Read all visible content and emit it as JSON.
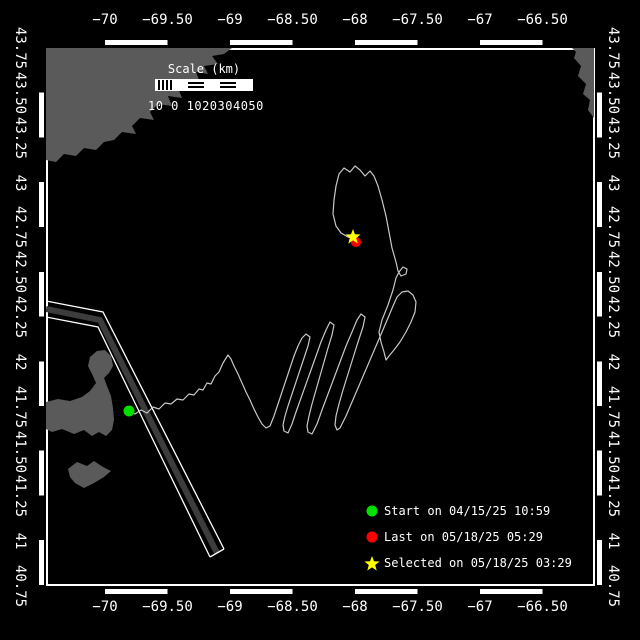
{
  "window": {
    "background": "#000000",
    "foreground": "#ffffff"
  },
  "axes": {
    "lon_ticks": [
      {
        "label": "−70",
        "x": 105
      },
      {
        "label": "−69.50",
        "x": 167.5
      },
      {
        "label": "−69",
        "x": 230
      },
      {
        "label": "−68.50",
        "x": 292.5
      },
      {
        "label": "−68",
        "x": 355
      },
      {
        "label": "−67.50",
        "x": 417.5
      },
      {
        "label": "−67",
        "x": 480
      },
      {
        "label": "−66.50",
        "x": 542.5
      }
    ],
    "lat_ticks": [
      {
        "label": "43.75",
        "y": 48
      },
      {
        "label": "43.50",
        "y": 92.8
      },
      {
        "label": "43.25",
        "y": 137.7
      },
      {
        "label": "43",
        "y": 182.5
      },
      {
        "label": "42.75",
        "y": 227.3
      },
      {
        "label": "42.50",
        "y": 272.2
      },
      {
        "label": "42.25",
        "y": 317
      },
      {
        "label": "42",
        "y": 361.8
      },
      {
        "label": "41.75",
        "y": 406.7
      },
      {
        "label": "41.50",
        "y": 451.5
      },
      {
        "label": "41.25",
        "y": 496.3
      },
      {
        "label": "41",
        "y": 541.2
      },
      {
        "label": "40.75",
        "y": 586
      }
    ]
  },
  "scalebar": {
    "title": "Scale (km)",
    "labels": "10 0 1020304050",
    "segments": [
      "hatch",
      "solid",
      "striped",
      "solid",
      "striped",
      "solid"
    ]
  },
  "legend": {
    "items": [
      {
        "marker": "circle",
        "color": "#00e000",
        "text": "Start on 04/15/25 10:59"
      },
      {
        "marker": "circle",
        "color": "#ff0000",
        "text": "Last on 05/18/25 05:29"
      },
      {
        "marker": "star",
        "color": "#ffff00",
        "text": "Selected on 05/18/25 03:29"
      }
    ]
  },
  "chart_data": {
    "type": "scatter",
    "title": "Glider track map",
    "xlabel": "Longitude (deg)",
    "ylabel": "Latitude (deg)",
    "xlim": [
      -70.48,
      -66.08
    ],
    "ylim": [
      40.75,
      43.75
    ],
    "legend_position": "bottom-right",
    "grid": false,
    "markers": {
      "start": {
        "lon": -69.81,
        "lat": 41.72,
        "label": "Start on 04/15/25 10:59"
      },
      "last": {
        "lon": -67.99,
        "lat": 42.67,
        "label": "Last on 05/18/25 05:29"
      },
      "selected": {
        "lon": -68.02,
        "lat": 42.7,
        "label": "Selected on 05/18/25 03:29"
      }
    }
  },
  "map": {
    "colors": {
      "land": "#5a5a5a",
      "track": "#c8c8c8",
      "lane_band": "#3c3c3c",
      "line": "#ffffff"
    },
    "land": [
      {
        "name": "maine-coast",
        "points": [
          [
            46,
            48
          ],
          [
            232,
            48
          ],
          [
            224,
            54
          ],
          [
            212,
            56
          ],
          [
            218,
            64
          ],
          [
            204,
            66
          ],
          [
            208,
            74
          ],
          [
            196,
            72
          ],
          [
            200,
            82
          ],
          [
            186,
            80
          ],
          [
            190,
            90
          ],
          [
            178,
            88
          ],
          [
            182,
            98
          ],
          [
            168,
            96
          ],
          [
            172,
            106
          ],
          [
            158,
            104
          ],
          [
            150,
            112
          ],
          [
            154,
            120
          ],
          [
            140,
            118
          ],
          [
            132,
            126
          ],
          [
            136,
            134
          ],
          [
            122,
            132
          ],
          [
            114,
            140
          ],
          [
            104,
            142
          ],
          [
            96,
            150
          ],
          [
            84,
            148
          ],
          [
            76,
            156
          ],
          [
            64,
            154
          ],
          [
            56,
            162
          ],
          [
            46,
            160
          ]
        ]
      },
      {
        "name": "nova-scotia",
        "points": [
          [
            572,
            48
          ],
          [
            594,
            48
          ],
          [
            594,
            118
          ],
          [
            588,
            110
          ],
          [
            590,
            100
          ],
          [
            583,
            94
          ],
          [
            586,
            84
          ],
          [
            578,
            76
          ],
          [
            581,
            66
          ],
          [
            574,
            58
          ],
          [
            576,
            52
          ]
        ]
      },
      {
        "name": "cape-cod",
        "points": [
          [
            46,
            402
          ],
          [
            58,
            399
          ],
          [
            70,
            401
          ],
          [
            82,
            397
          ],
          [
            90,
            391
          ],
          [
            96,
            383
          ],
          [
            92,
            374
          ],
          [
            88,
            366
          ],
          [
            90,
            357
          ],
          [
            97,
            351
          ],
          [
            105,
            350
          ],
          [
            111,
            356
          ],
          [
            113,
            366
          ],
          [
            109,
            373
          ],
          [
            104,
            378
          ],
          [
            107,
            386
          ],
          [
            111,
            396
          ],
          [
            113,
            408
          ],
          [
            114,
            420
          ],
          [
            112,
            430
          ],
          [
            106,
            436
          ],
          [
            99,
            432
          ],
          [
            92,
            436
          ],
          [
            84,
            430
          ],
          [
            74,
            434
          ],
          [
            62,
            429
          ],
          [
            52,
            432
          ],
          [
            46,
            429
          ]
        ]
      },
      {
        "name": "islands",
        "points": [
          [
            68,
            469
          ],
          [
            77,
            462
          ],
          [
            87,
            466
          ],
          [
            94,
            461
          ],
          [
            103,
            467
          ],
          [
            111,
            471
          ],
          [
            104,
            477
          ],
          [
            94,
            483
          ],
          [
            84,
            488
          ],
          [
            75,
            483
          ],
          [
            70,
            477
          ]
        ]
      }
    ],
    "lane": {
      "outer": [
        [
          46,
          301
        ],
        [
          103,
          312
        ],
        [
          224,
          549
        ]
      ],
      "inner": [
        [
          46,
          317
        ],
        [
          98,
          327
        ],
        [
          210,
          557
        ]
      ],
      "band": [
        [
          46,
          309
        ],
        [
          100,
          320
        ],
        [
          217,
          553
        ]
      ],
      "cap": [
        [
          210,
          557
        ],
        [
          224,
          549
        ]
      ]
    },
    "track": [
      [
        129,
        411
      ],
      [
        135,
        414
      ],
      [
        141,
        410
      ],
      [
        147,
        413
      ],
      [
        153,
        407
      ],
      [
        159,
        409
      ],
      [
        165,
        403
      ],
      [
        171,
        404
      ],
      [
        177,
        399
      ],
      [
        183,
        400
      ],
      [
        189,
        394
      ],
      [
        194,
        395
      ],
      [
        199,
        389
      ],
      [
        203,
        390
      ],
      [
        207,
        383
      ],
      [
        211,
        384
      ],
      [
        215,
        376
      ],
      [
        219,
        372
      ],
      [
        223,
        363
      ],
      [
        228,
        355
      ],
      [
        231,
        359
      ],
      [
        234,
        366
      ],
      [
        238,
        374
      ],
      [
        242,
        383
      ],
      [
        246,
        392
      ],
      [
        250,
        400
      ],
      [
        254,
        409
      ],
      [
        258,
        417
      ],
      [
        262,
        424
      ],
      [
        266,
        428
      ],
      [
        270,
        426
      ],
      [
        274,
        416
      ],
      [
        278,
        404
      ],
      [
        282,
        392
      ],
      [
        286,
        380
      ],
      [
        290,
        368
      ],
      [
        294,
        356
      ],
      [
        298,
        346
      ],
      [
        302,
        338
      ],
      [
        306,
        334
      ],
      [
        310,
        337
      ],
      [
        308,
        346
      ],
      [
        304,
        358
      ],
      [
        300,
        370
      ],
      [
        296,
        382
      ],
      [
        292,
        394
      ],
      [
        288,
        406
      ],
      [
        285,
        416
      ],
      [
        283,
        425
      ],
      [
        284,
        431
      ],
      [
        288,
        433
      ],
      [
        292,
        424
      ],
      [
        296,
        412
      ],
      [
        301,
        398
      ],
      [
        306,
        384
      ],
      [
        311,
        370
      ],
      [
        316,
        356
      ],
      [
        321,
        342
      ],
      [
        326,
        330
      ],
      [
        330,
        322
      ],
      [
        334,
        325
      ],
      [
        332,
        335
      ],
      [
        328,
        348
      ],
      [
        324,
        362
      ],
      [
        320,
        376
      ],
      [
        316,
        390
      ],
      [
        312,
        404
      ],
      [
        309,
        416
      ],
      [
        307,
        426
      ],
      [
        308,
        432
      ],
      [
        312,
        434
      ],
      [
        317,
        424
      ],
      [
        322,
        410
      ],
      [
        328,
        394
      ],
      [
        334,
        378
      ],
      [
        340,
        362
      ],
      [
        346,
        346
      ],
      [
        352,
        332
      ],
      [
        357,
        320
      ],
      [
        361,
        314
      ],
      [
        365,
        317
      ],
      [
        363,
        327
      ],
      [
        358,
        342
      ],
      [
        353,
        358
      ],
      [
        348,
        374
      ],
      [
        343,
        390
      ],
      [
        339,
        404
      ],
      [
        336,
        416
      ],
      [
        335,
        425
      ],
      [
        337,
        430
      ],
      [
        340,
        428
      ],
      [
        346,
        416
      ],
      [
        352,
        402
      ],
      [
        358,
        388
      ],
      [
        364,
        374
      ],
      [
        370,
        360
      ],
      [
        376,
        346
      ],
      [
        382,
        332
      ],
      [
        388,
        318
      ],
      [
        393,
        306
      ],
      [
        397,
        297
      ],
      [
        402,
        292
      ],
      [
        408,
        291
      ],
      [
        413,
        295
      ],
      [
        416,
        302
      ],
      [
        415,
        312
      ],
      [
        411,
        322
      ],
      [
        406,
        332
      ],
      [
        400,
        342
      ],
      [
        394,
        350
      ],
      [
        389,
        356
      ],
      [
        386,
        360
      ],
      [
        384,
        352
      ],
      [
        381,
        342
      ],
      [
        379,
        332
      ],
      [
        382,
        320
      ],
      [
        388,
        305
      ],
      [
        393,
        290
      ],
      [
        396,
        278
      ],
      [
        399,
        272
      ],
      [
        403,
        267
      ],
      [
        407,
        269
      ],
      [
        406,
        274
      ],
      [
        401,
        276
      ],
      [
        398,
        271
      ],
      [
        396,
        262
      ],
      [
        392,
        248
      ],
      [
        389,
        232
      ],
      [
        386,
        216
      ],
      [
        382,
        200
      ],
      [
        378,
        186
      ],
      [
        374,
        176
      ],
      [
        370,
        171
      ],
      [
        365,
        176
      ],
      [
        360,
        170
      ],
      [
        355,
        166
      ],
      [
        350,
        172
      ],
      [
        344,
        168
      ],
      [
        339,
        174
      ],
      [
        336,
        186
      ],
      [
        334,
        200
      ],
      [
        333,
        214
      ],
      [
        336,
        226
      ],
      [
        341,
        233
      ],
      [
        348,
        237
      ],
      [
        353,
        238
      ],
      [
        355,
        241
      ]
    ],
    "markers": {
      "start": {
        "x": 129,
        "y": 411,
        "color": "#00e000",
        "r": 5.5
      },
      "last": {
        "x": 356,
        "y": 242,
        "color": "#ff0000",
        "r": 5
      },
      "selected": {
        "x": 353,
        "y": 237,
        "color": "#ffff00",
        "size": 8
      }
    }
  }
}
